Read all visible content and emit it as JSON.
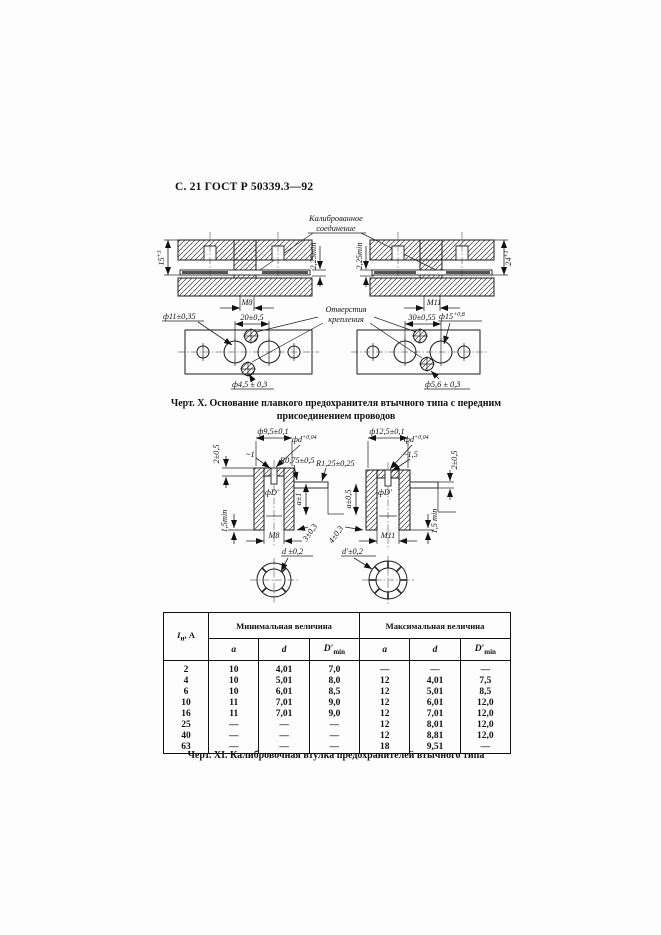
{
  "header": "С. 21 ГОСТ Р 50339.3—92",
  "figX": {
    "callout_l1": "Калиброванное",
    "callout_l2": "соединение",
    "dim15": {
      "base": "15",
      "sup": "+3"
    },
    "gap_left": "2,25min",
    "gap_right": "2,25min",
    "m8": "М8",
    "m11": "М11",
    "dim24": {
      "base": "24",
      "sup": "+1"
    },
    "holes_l1": "Отверстия",
    "holes_l2": "крепления",
    "d11": "ф11±0,35",
    "d20": "20±0,5",
    "d30": "30±0,55",
    "d15": {
      "base": "ф15",
      "sup": "+0,8"
    },
    "d45": "ф4,5 ± 0,3",
    "d56": "ф5,6 ± 0,3",
    "cap1": "Черт. X. Основание плавкого предохранителя втычного типа с передним",
    "cap2": "присоединением проводов"
  },
  "figXI": {
    "left": {
      "d95": "ф9,5±0,1",
      "lip": "2±0,5",
      "dd": {
        "base": "фd",
        "sup": "+0,04"
      },
      "slot": "~1",
      "r075": "R0,75±0,5",
      "r125": "R1,25±0,25",
      "dD": "фD′",
      "a": "a±1",
      "min15": "1,5min",
      "m8": "М8",
      "s3": "3±0,3",
      "circ": "d ±0,2"
    },
    "right": {
      "d125": "ф12,5±0,1",
      "dd": {
        "base": "фd",
        "sup": "+0,04"
      },
      "slot": "~1,5",
      "lip": "2±0,5",
      "a": "a±0,5",
      "dD": "фD′",
      "s4": "4±0,3",
      "m11": "М11",
      "min15": "1,5 min",
      "circ": "d′±0,2"
    },
    "caption": "Черт. XI. Калибровочная втулка предохранителей втычного типа"
  },
  "table": {
    "col_current": {
      "base": "I",
      "sub": "н",
      "unit": ", А"
    },
    "group_min": "Минимальная величина",
    "group_max": "Максимальная величина",
    "sub_a": "a",
    "sub_d": "d",
    "sub_dmin": {
      "base": "D′",
      "sub": "min"
    },
    "rows": [
      [
        "2",
        "10",
        "4,01",
        "7,0",
        "—",
        "—",
        "—"
      ],
      [
        "4",
        "10",
        "5,01",
        "8,0",
        "12",
        "4,01",
        "7,5"
      ],
      [
        "6",
        "10",
        "6,01",
        "8,5",
        "12",
        "5,01",
        "8,5"
      ],
      [
        "10",
        "11",
        "7,01",
        "9,0",
        "12",
        "6,01",
        "12,0"
      ],
      [
        "16",
        "11",
        "7,01",
        "9,0",
        "12",
        "7,01",
        "12,0"
      ],
      [
        "25",
        "—",
        "—",
        "—",
        "12",
        "8,01",
        "12,0"
      ],
      [
        "40",
        "—",
        "—",
        "—",
        "12",
        "8,81",
        "12,0"
      ],
      [
        "63",
        "—",
        "—",
        "—",
        "18",
        "9,51",
        "—"
      ]
    ]
  }
}
